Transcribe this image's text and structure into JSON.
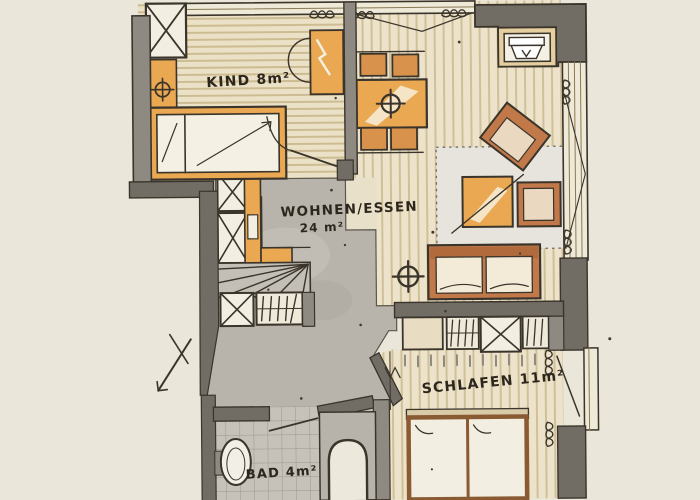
{
  "plan": {
    "type": "hand-drawn apartment floor plan (scan)",
    "rooms": [
      {
        "id": "kind",
        "label": "KIND 8m²"
      },
      {
        "id": "wohnen_essen",
        "label": "WOHNEN/ESSEN",
        "area_label": "24 m²"
      },
      {
        "id": "schlafen",
        "label": "SCHLAFEN 11m²"
      },
      {
        "id": "bad",
        "label": "BAD 4m²"
      }
    ],
    "furniture": [
      "single-bed",
      "wardrobe",
      "dining-table",
      "four-chairs",
      "tv",
      "armchair",
      "armchair",
      "coffee-table",
      "sofa",
      "rug",
      "stairs",
      "double-bed",
      "toilet",
      "shower",
      "ceiling-light",
      "ceiling-light",
      "ceiling-light"
    ],
    "palette": {
      "paper": "#eae6d9",
      "wood_floor": "#ebe1c6",
      "wood_stripe": "#cdbc92",
      "gray_floor": "#b8b4ac",
      "wall_mid": "#8e8a81",
      "wall_dark": "#716d65",
      "window_band": "#efe9d8",
      "furniture_orange": "#e9a851",
      "furniture_sienna": "#c2794a",
      "bed_frame_brown": "#8a5a33",
      "ink": "#3a342b"
    }
  }
}
